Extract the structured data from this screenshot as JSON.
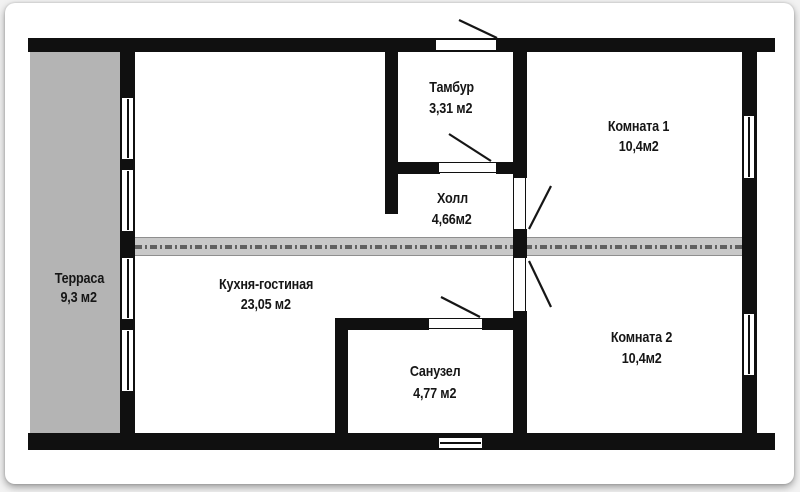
{
  "plan": {
    "title": "apartment-floor-plan",
    "rooms": [
      {
        "name": "Терраса",
        "area": "9,3 м2"
      },
      {
        "name": "Тамбур",
        "area": "3,31 м2"
      },
      {
        "name": "Холл",
        "area": "4,66м2"
      },
      {
        "name": "Комната 1",
        "area": "10,4м2"
      },
      {
        "name": "Кухня-гостиная",
        "area": "23,05 м2"
      },
      {
        "name": "Санузел",
        "area": "4,77 м2"
      },
      {
        "name": "Комната 2",
        "area": "10,4м2"
      }
    ],
    "colors": {
      "wall": "#101010",
      "terrace_fill": "#b4b4b4",
      "partition_strip": "#c8c8c8",
      "strip_dashes": "#606060",
      "paper": "#ffffff"
    }
  }
}
